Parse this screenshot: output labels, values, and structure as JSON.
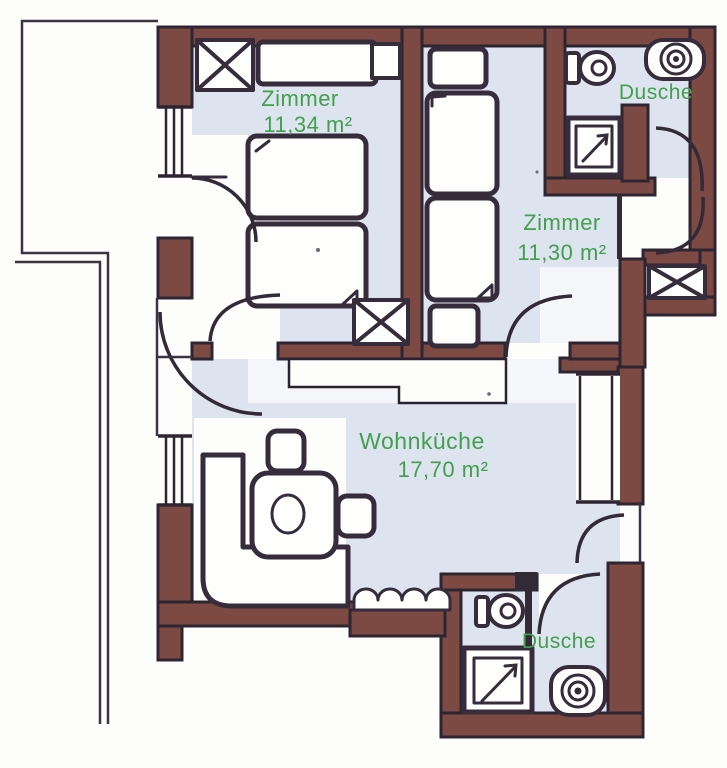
{
  "document": {
    "type": "apartment-floor-plan"
  },
  "colors": {
    "wall_fill": "#7c4a43",
    "wall_outline": "#2e2532",
    "floor": "#dde4f0",
    "ink_line": "#362c3b",
    "label_green": "#42a04c",
    "paper": "#fdfdfb"
  },
  "rooms": [
    {
      "name": "Zimmer",
      "area": "11,34 m²"
    },
    {
      "name": "Zimmer",
      "area": "11,30 m²"
    },
    {
      "name": "Wohnküche",
      "area": "17,70 m²"
    },
    {
      "name": "Dusche"
    },
    {
      "name": "Dusche"
    }
  ],
  "icons": [
    "wardrobe-cross-box-icon",
    "bed-icon",
    "nightstand-icon",
    "dresser-icon",
    "dining-table-icon",
    "chair-icon",
    "corner-bench-icon",
    "sofa-icon",
    "kitchen-counter-icon",
    "toilet-icon",
    "washbasin-icon",
    "shower-icon",
    "door-swing-icon",
    "window-icon"
  ]
}
